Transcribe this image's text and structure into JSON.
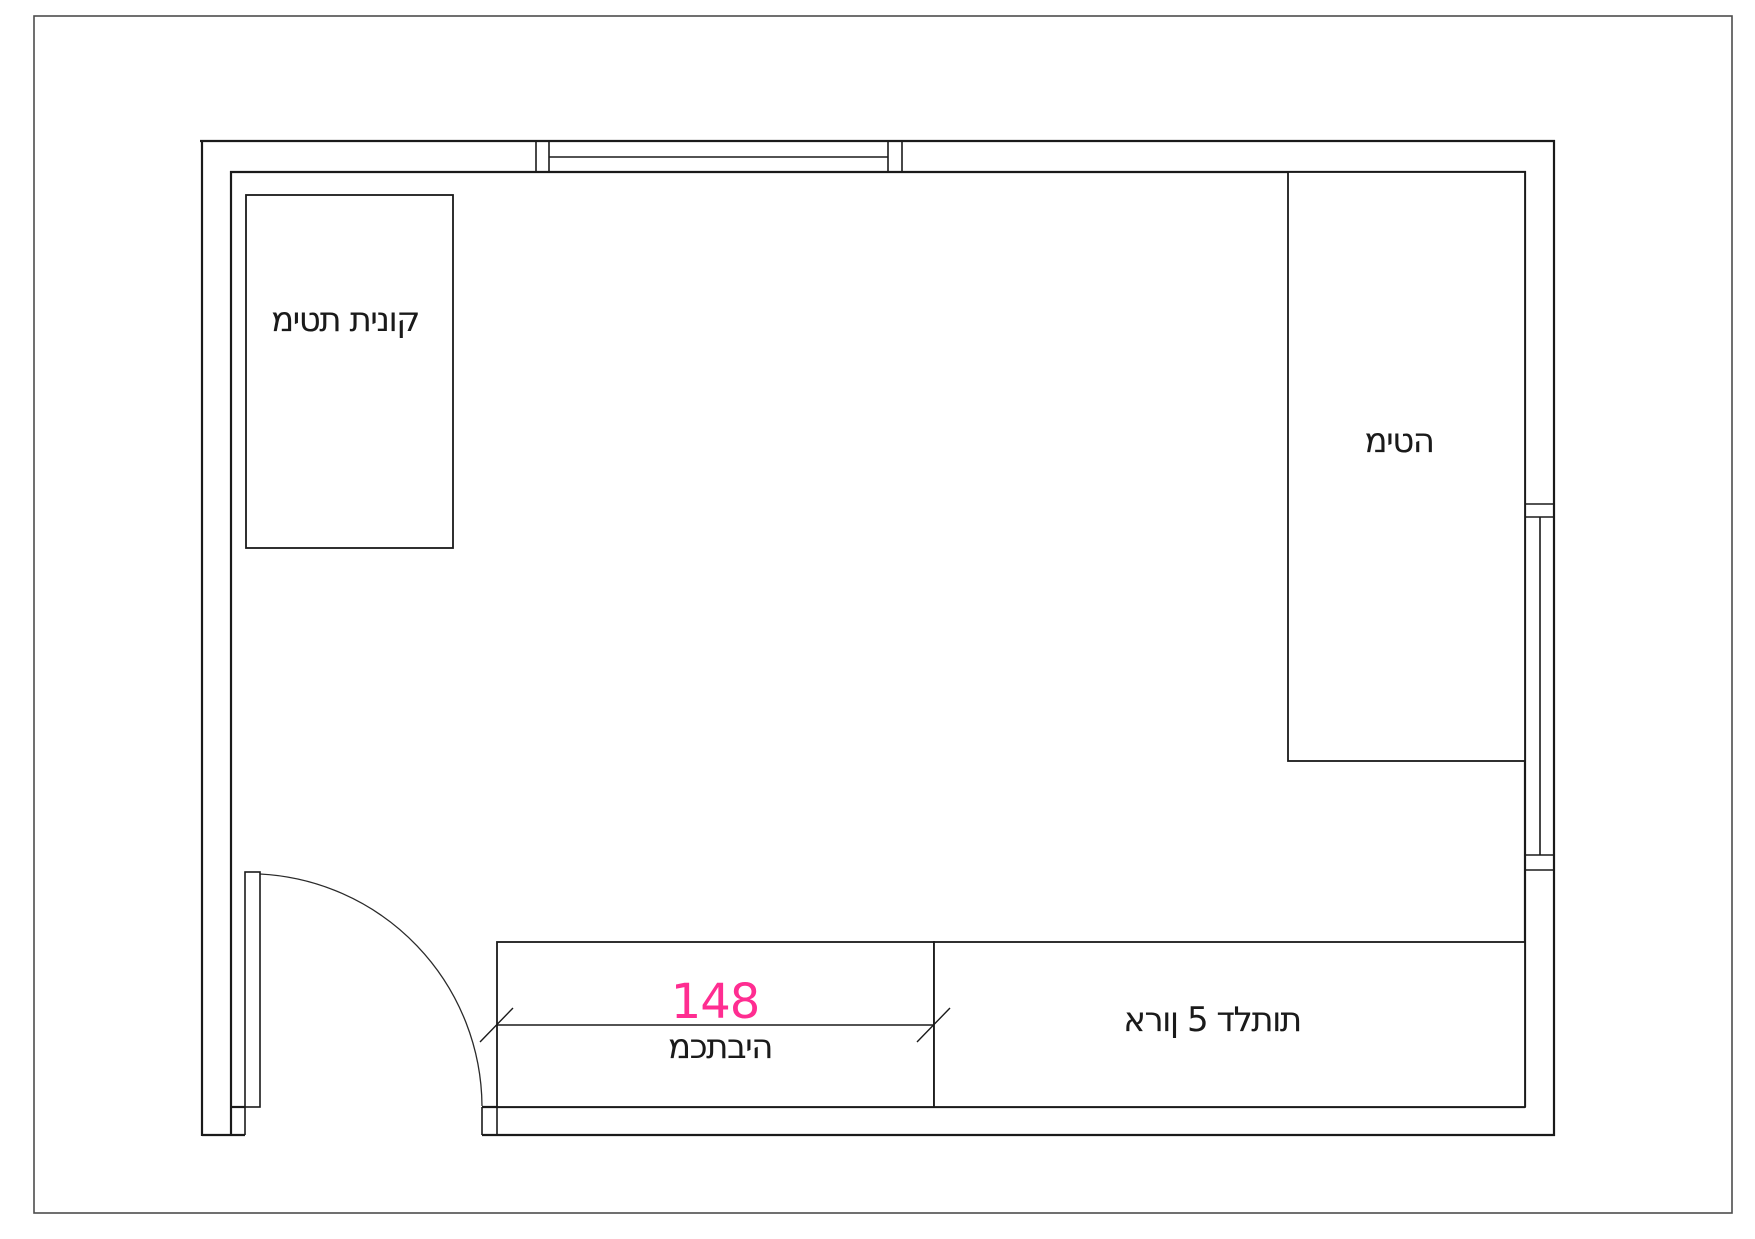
{
  "canvas": {
    "type": "floor-plan",
    "background": "#ffffff",
    "colors": {
      "wall_line": "#1a1a1a",
      "page_border": "#4d4d4d",
      "label_text": "#1a1a1a",
      "dimension_accent": "#ff2d91"
    }
  },
  "room": {
    "furniture": [
      {
        "name": "crib",
        "label": "מיטת תינוק"
      },
      {
        "name": "bed",
        "label": "מיטה"
      },
      {
        "name": "desk",
        "label": "מכתביה"
      },
      {
        "name": "closet",
        "label": "ארון 5 דלתות"
      }
    ],
    "dimension": {
      "value": "148"
    }
  }
}
